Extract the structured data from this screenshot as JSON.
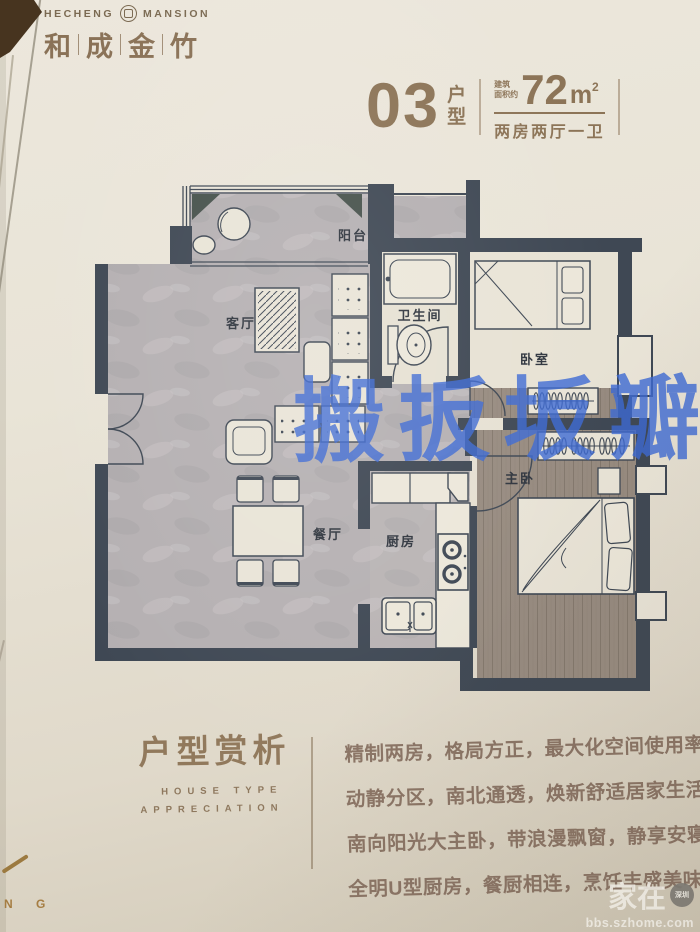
{
  "brand": {
    "en_left": "HECHENG",
    "en_right": "MANSION",
    "cn": [
      "和",
      "成",
      "金",
      "竹"
    ]
  },
  "unit": {
    "number": "03",
    "type_chars": [
      "户",
      "型"
    ],
    "area_prefix_lines": [
      "建筑",
      "面积约"
    ],
    "area_value": "72",
    "area_unit": "m",
    "area_sup": "2",
    "layout": "两房两厅一卫"
  },
  "plan": {
    "rooms": {
      "balcony": "阳台",
      "living": "客厅",
      "bathroom": "卫生间",
      "bedroom": "卧室",
      "master": "主卧",
      "dining": "餐厅",
      "kitchen": "厨房"
    }
  },
  "watermark": {
    "center": "搬扳坂瓣"
  },
  "appreciation": {
    "title": "户型赏析",
    "en_line1": "HOUSE TYPE",
    "en_line2": "APPRECIATION",
    "lines": [
      "精制两房，格局方正，最大化空间使用率；",
      "动静分区，南北通透，焕新舒适居家生活；",
      "南向阳光大主卧，带浪漫飘窗，静享安寝；",
      "全明U型厨房，餐厨相连，烹饪丰盛美味。"
    ]
  },
  "site": {
    "name": "家在",
    "badge": "深圳",
    "url": "bbs.szhome.com"
  },
  "artifacts": {
    "corner_letters": "N G"
  },
  "colors": {
    "brand_brown": "#8a7257",
    "wall_dark": "#3f4854",
    "watermark_blue": "#3d6ad4",
    "paper": "#e9e4d8"
  }
}
